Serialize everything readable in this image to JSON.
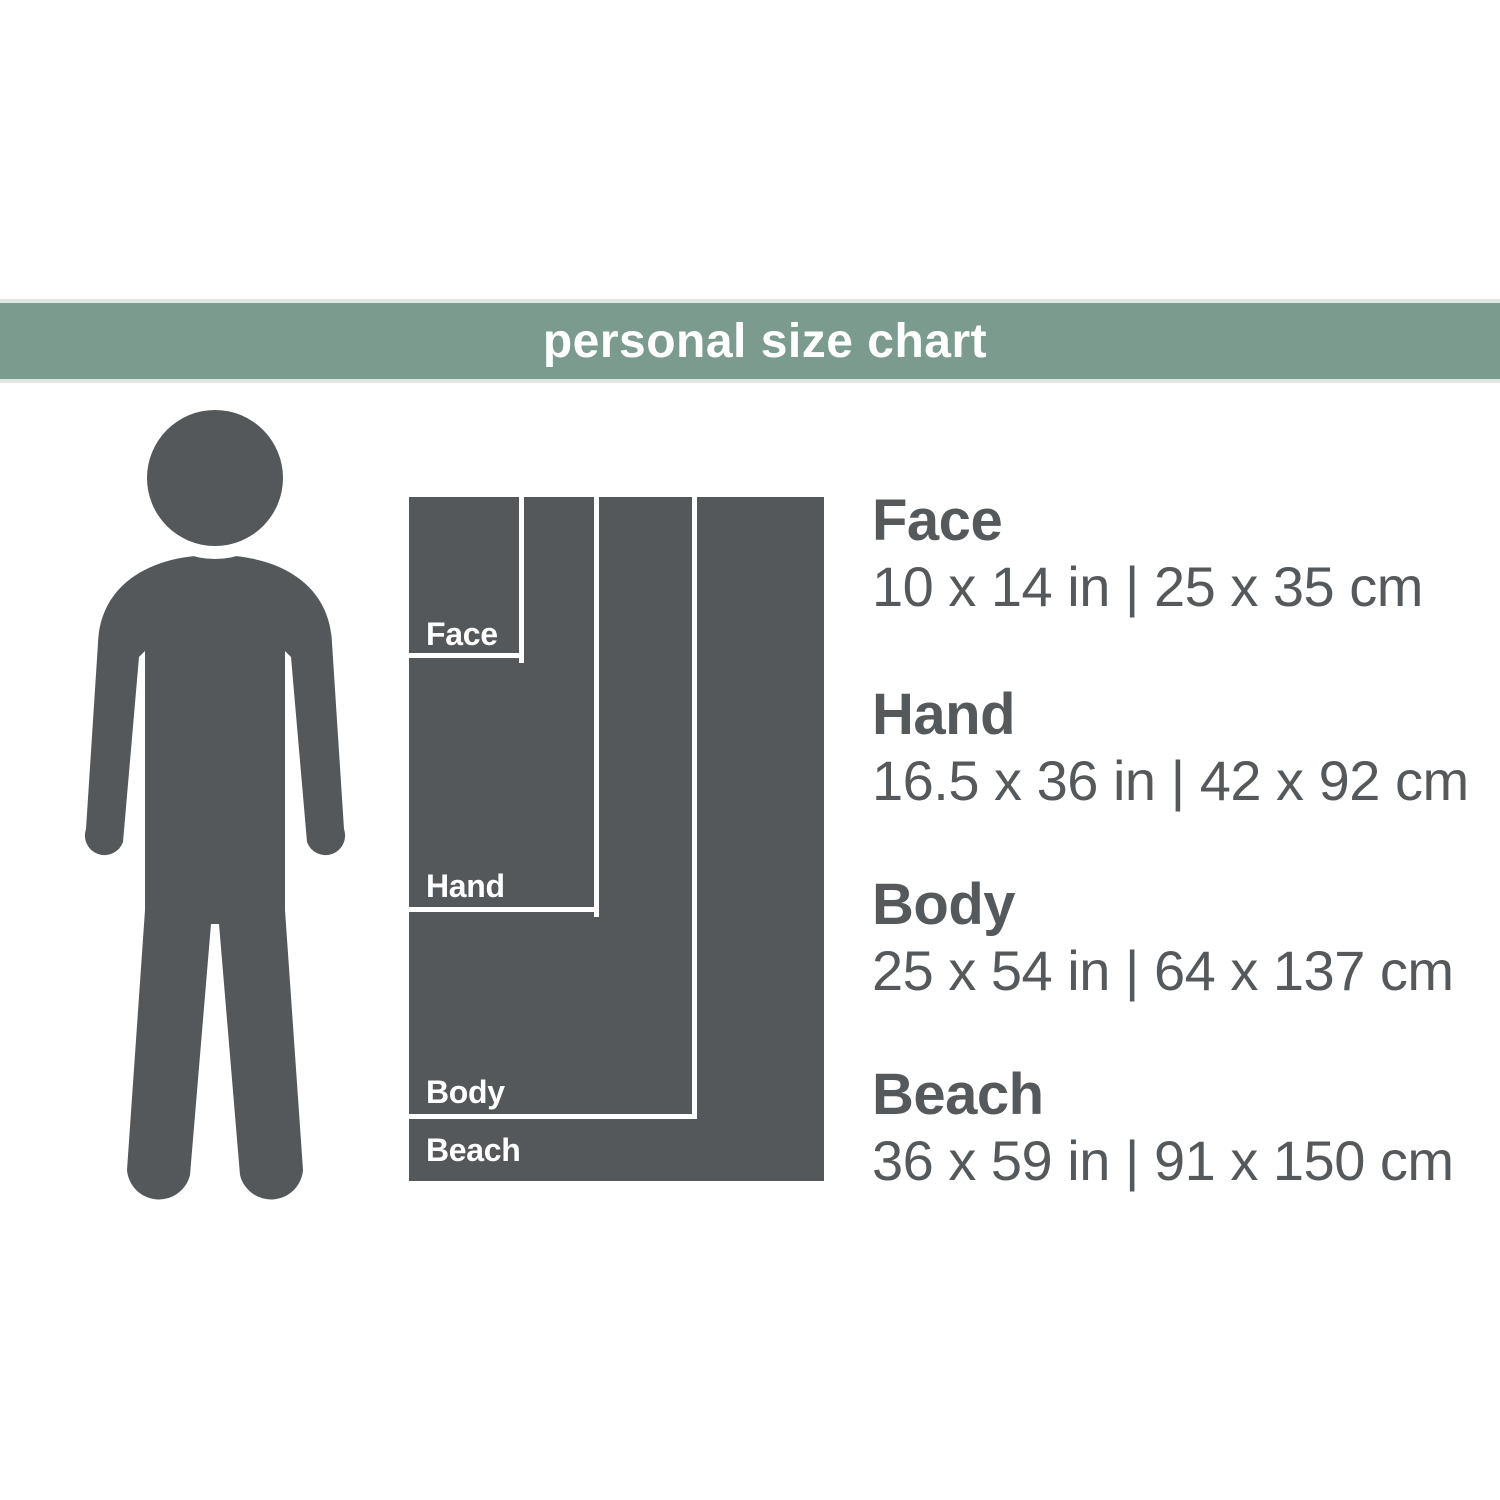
{
  "header": {
    "title": "personal size chart"
  },
  "theme": {
    "accent_green": "#7a9b8d",
    "accent_green_edge": "#dde8e2",
    "dark_gray": "#54585b",
    "text_gray": "#55595c",
    "background": "#ffffff"
  },
  "figure": {
    "icon": "person-silhouette",
    "color": "#54585b"
  },
  "diagram": {
    "description": "nested towel rectangles drawn to scale, anchored top-left",
    "pixels_per_inch": 11.5,
    "outline_color": "#ffffff"
  },
  "sizes": [
    {
      "name": "Face",
      "inches": "10 x 14 in",
      "cm": "25 x 35 cm",
      "dims": "10 x 14 in | 25 x 35 cm",
      "in_w": 10,
      "in_h": 14,
      "cm_w": 25,
      "cm_h": 35
    },
    {
      "name": "Hand",
      "inches": "16.5 x 36 in",
      "cm": "42 x 92 cm",
      "dims": "16.5 x 36 in | 42 x 92 cm",
      "in_w": 16.5,
      "in_h": 36,
      "cm_w": 42,
      "cm_h": 92
    },
    {
      "name": "Body",
      "inches": "25 x 54 in",
      "cm": "64 x 137 cm",
      "dims": "25 x 54 in | 64 x 137 cm",
      "in_w": 25,
      "in_h": 54,
      "cm_w": 64,
      "cm_h": 137
    },
    {
      "name": "Beach",
      "inches": "36 x 59 in",
      "cm": "91 x 150 cm",
      "dims": "36 x 59 in | 91 x 150 cm",
      "in_w": 36,
      "in_h": 59,
      "cm_w": 91,
      "cm_h": 150
    }
  ]
}
